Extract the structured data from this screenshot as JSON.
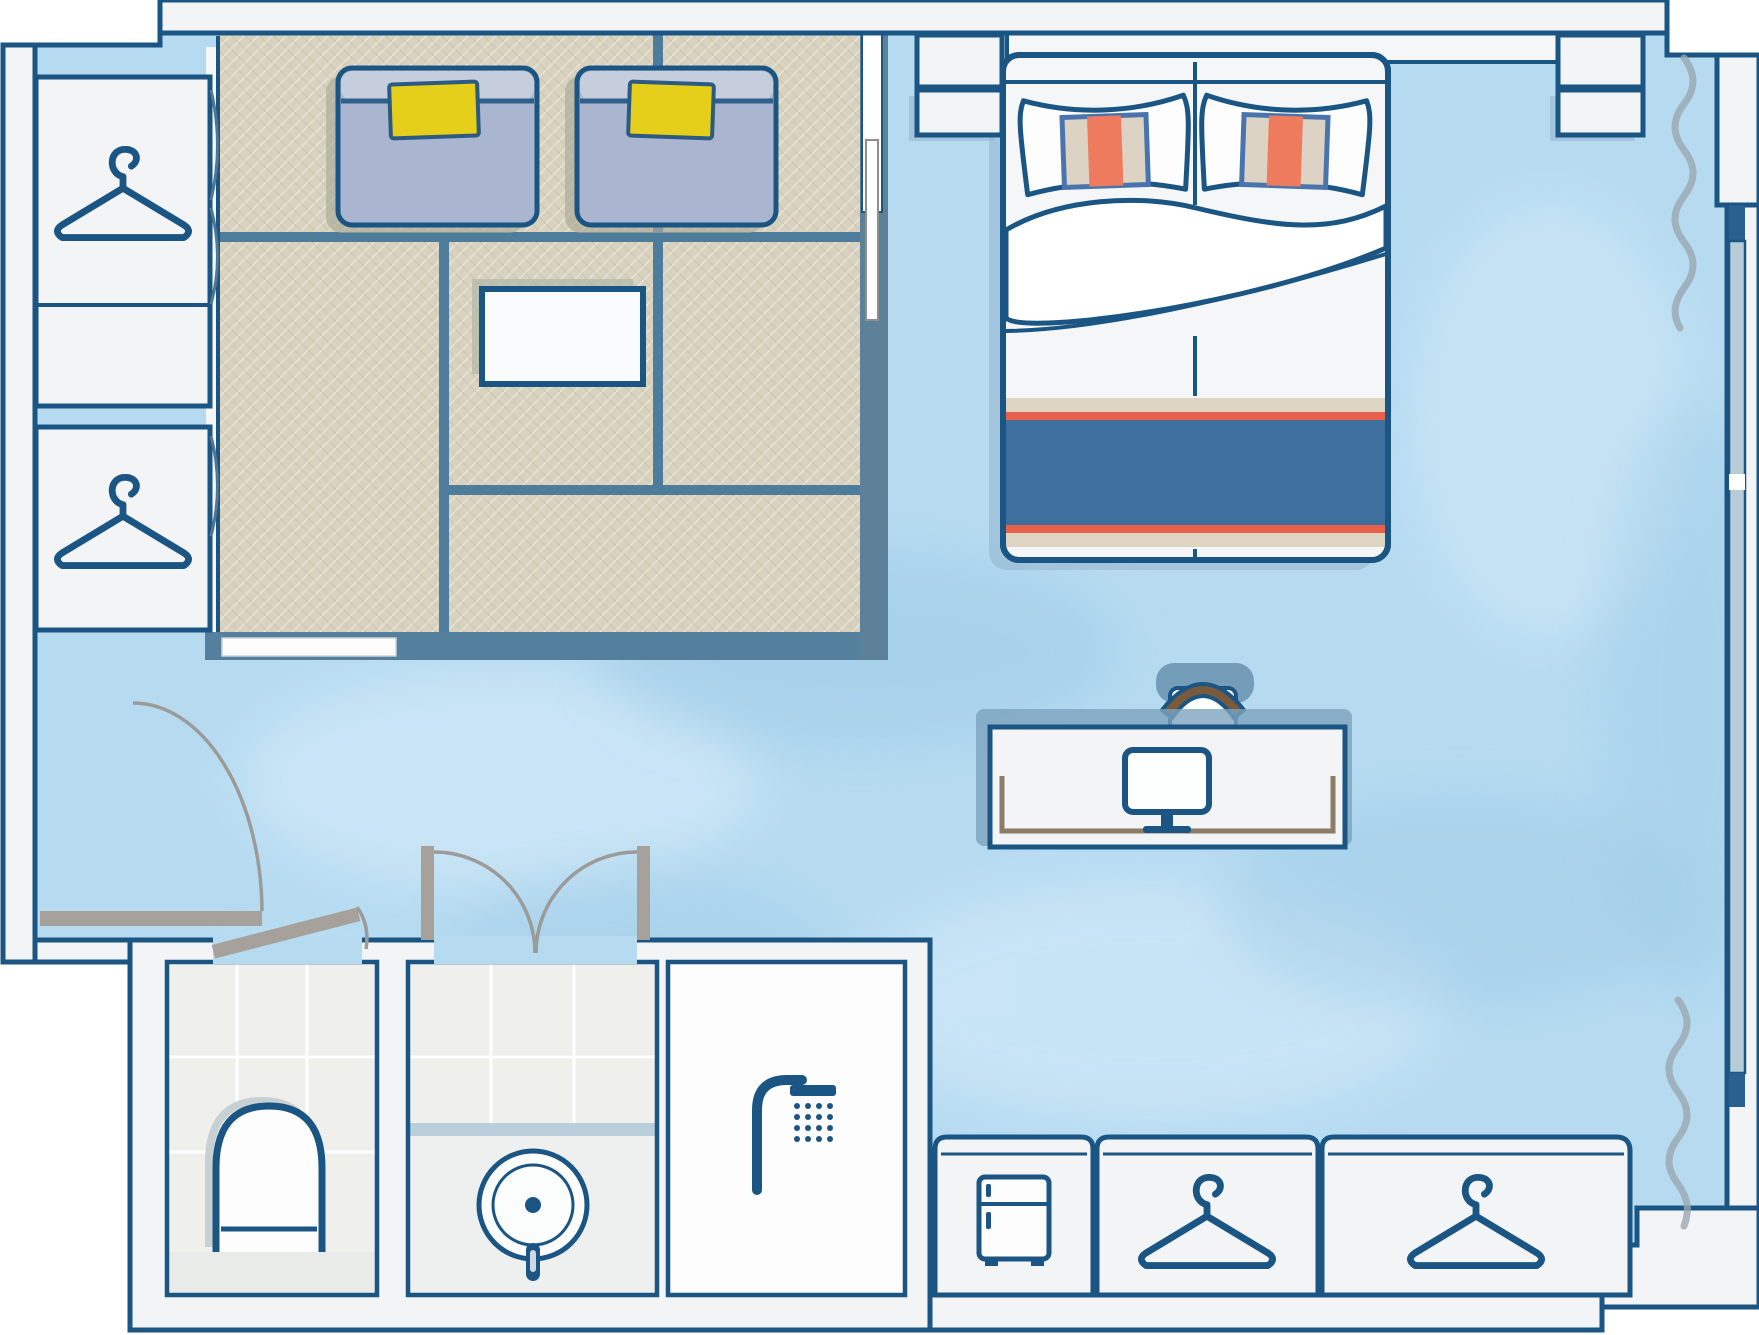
{
  "meta": {
    "kind": "floor-plan-illustration",
    "subject": "hotel-guest-room-floorplan",
    "visible_text": []
  },
  "theme": {
    "colors": {
      "outline": "#1b5583",
      "wall": "#f2f4f6",
      "outside": "#ffffff",
      "floor": "#b6dbf1",
      "floorlight": "#d9edf9",
      "floorshade": "#9ccae6",
      "tatami": "#d8d2be",
      "tatamiline": "#4e7d9b",
      "platformedge": "#54809d",
      "partition": "#5d8198",
      "stepwhite": "#fcfcfc",
      "futon": "#aab6cf",
      "futonlight": "#c6cddd",
      "futonfold": "#2e6089",
      "futonshadow": "#a8ab98",
      "pillowyellow": "#e5cf1a",
      "bedwhite": "#f4f6f7",
      "runnerbeige": "#ddd5c2",
      "runnerred": "#e8604c",
      "runnerblue": "#3e6f9f",
      "pillowborder": "#4a74ad",
      "pillowbeige": "#ddd3c4",
      "pilloworange": "#ee7b5e",
      "shadowslate": "#8fb0c9",
      "deskshadow": "#7da3be",
      "chairshadow": "#6b96b3",
      "chairbrown": "#7a5a3c",
      "deskinner": "#8b7d68",
      "doorgray": "#a6a29b",
      "arcgray": "#9b9b99",
      "curtain": "#9aa7b2",
      "windowglass": "#b6cdd8",
      "windowdark": "#2a6090",
      "tile": "#efefec",
      "tilestep": "#e9ebe8",
      "grout": "#ffffff",
      "counteredge": "#b9cfdc",
      "counter": "#eef0ef",
      "showerfloor": "#fdfdfe",
      "tableshadow": "#b3b9ac",
      "iconwhite": "#fdfdfd"
    }
  },
  "rooms": [
    {
      "name": "tatami-area",
      "floor": "tatami-mats",
      "mats": 5
    },
    {
      "name": "bedroom-area",
      "floor": "carpet-blue"
    },
    {
      "name": "entry-hall",
      "floor": "carpet-blue"
    },
    {
      "name": "toilet-room",
      "floor": "tile"
    },
    {
      "name": "vanity-room",
      "floor": "tile"
    },
    {
      "name": "shower-room",
      "floor": "waterproof"
    }
  ],
  "furniture": [
    {
      "name": "futon-bed",
      "count": 2,
      "accessory": "yellow-cushion"
    },
    {
      "name": "low-table",
      "count": 1
    },
    {
      "name": "double-bed",
      "pillows": 2,
      "runner_stripes": [
        "beige",
        "red",
        "blue",
        "red",
        "beige"
      ]
    },
    {
      "name": "nightstand",
      "count": 4
    },
    {
      "name": "desk-with-chair",
      "count": 1
    },
    {
      "name": "wardrobe-closet-left",
      "count": 2,
      "icon": "hanger-icon"
    },
    {
      "name": "closet-row-bottom",
      "count": 3,
      "icons": [
        "fridge-icon",
        "hanger-icon",
        "hanger-icon"
      ]
    },
    {
      "name": "toilet",
      "count": 1
    },
    {
      "name": "sink-basin",
      "count": 1
    },
    {
      "name": "shower",
      "count": 1,
      "icon": "shower-icon"
    },
    {
      "name": "monitor",
      "count": 1,
      "icon": "monitor-icon"
    }
  ],
  "openings": [
    {
      "name": "entrance-door",
      "type": "swing-door"
    },
    {
      "name": "toilet-door",
      "type": "swing-door-ajar"
    },
    {
      "name": "bathroom-double-doors",
      "type": "double-swing"
    },
    {
      "name": "sliding-partition",
      "type": "sliding-doors"
    },
    {
      "name": "window-right",
      "type": "glazing",
      "curtains": 2
    }
  ]
}
